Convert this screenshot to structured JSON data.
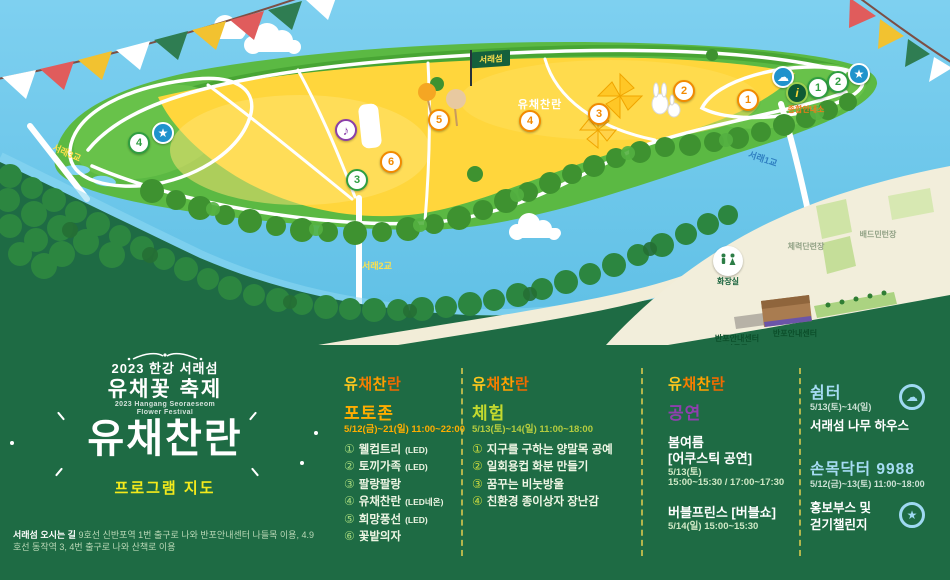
{
  "logo_chars": [
    "유",
    "채",
    "찬",
    "란"
  ],
  "icons": {
    "cloud": "☁",
    "star": "★",
    "music": "♪",
    "info": "i"
  },
  "map": {
    "flag_label": "서래섬",
    "field_logo": "유채찬란",
    "bridge1": "서래1교",
    "bridge2": "서래2교",
    "bridge3": "서래3교",
    "info_label": "종합안내소",
    "toilet_label": "화장실",
    "fitness_label": "체력단련장",
    "badminton_label": "배드민턴장",
    "banpo_center_label": "반포안내센터",
    "banpo_gate_label1": "반포안내센터",
    "banpo_gate_label2": "나들목",
    "photo_markers": [
      "1",
      "2",
      "3",
      "4",
      "5",
      "6"
    ],
    "exp_markers": [
      "1",
      "2",
      "3",
      "4"
    ]
  },
  "brand": {
    "top_line": "2023 한강 서래섬",
    "title": "유채꽃 축제",
    "subtitle_en1": "2023 Hangang Seoraeseom",
    "subtitle_en2": "Flower Festival",
    "logo": "유채찬란",
    "program_label": "프로그램 지도"
  },
  "directions": {
    "label": "서래섬 오시는 길",
    "line1": "9호선 신반포역 1번 출구로 나와 반포안내센터 나들목 이용,",
    "line2": "4.9호선 동작역 3, 4번 출구로 나와 산책로 이용"
  },
  "photo_zone": {
    "title": "포토존",
    "date": "5/12(금)~21(일) 11:00~22:00",
    "items": [
      {
        "num": "①",
        "name": "웰컴트리",
        "note": "(LED)"
      },
      {
        "num": "②",
        "name": "토끼가족",
        "note": "(LED)"
      },
      {
        "num": "③",
        "name": "팔랑팔랑",
        "note": ""
      },
      {
        "num": "④",
        "name": "유채찬란",
        "note": "(LED네온)"
      },
      {
        "num": "⑤",
        "name": "희망풍선",
        "note": "(LED)"
      },
      {
        "num": "⑥",
        "name": "꽃밭의자",
        "note": ""
      }
    ]
  },
  "experience": {
    "title": "체험",
    "date": "5/13(토)~14(일) 11:00~18:00",
    "items": [
      {
        "num": "①",
        "name": "지구를 구하는 양말목 공예"
      },
      {
        "num": "②",
        "name": "일회용컵 화분 만들기"
      },
      {
        "num": "③",
        "name": "꿈꾸는 비눗방울"
      },
      {
        "num": "④",
        "name": "친환경 종이상자 장난감"
      }
    ]
  },
  "performance": {
    "title": "공연",
    "event1_name": "봄여름",
    "event1_sub": "[어쿠스틱 공연]",
    "event1_date": "5/13(토)",
    "event1_time": "15:00~15:30 / 17:00~17:30",
    "event2_name": "버블프린스 [버블쇼]",
    "event2_time": "5/14(일) 15:00~15:30"
  },
  "shelter": {
    "title": "쉼터",
    "date": "5/13(토)~14(일)",
    "desc": "서래섬 나무 하우스"
  },
  "wrist_doctor": {
    "title": "손목닥터 9988",
    "date": "5/12(금)~13(토) 11:00~18:00",
    "desc1": "홍보부스 및",
    "desc2": "걷기챌린지"
  },
  "colors": {
    "panel_green": "#1e6b44",
    "field_yellow": "#ffd63c",
    "accent_orange": "#ffad00",
    "accent_lime": "#c3d92e",
    "accent_purple": "#8f3fae",
    "accent_skyblue": "#a6dcf4",
    "program_yellow": "#f3ea1b"
  }
}
